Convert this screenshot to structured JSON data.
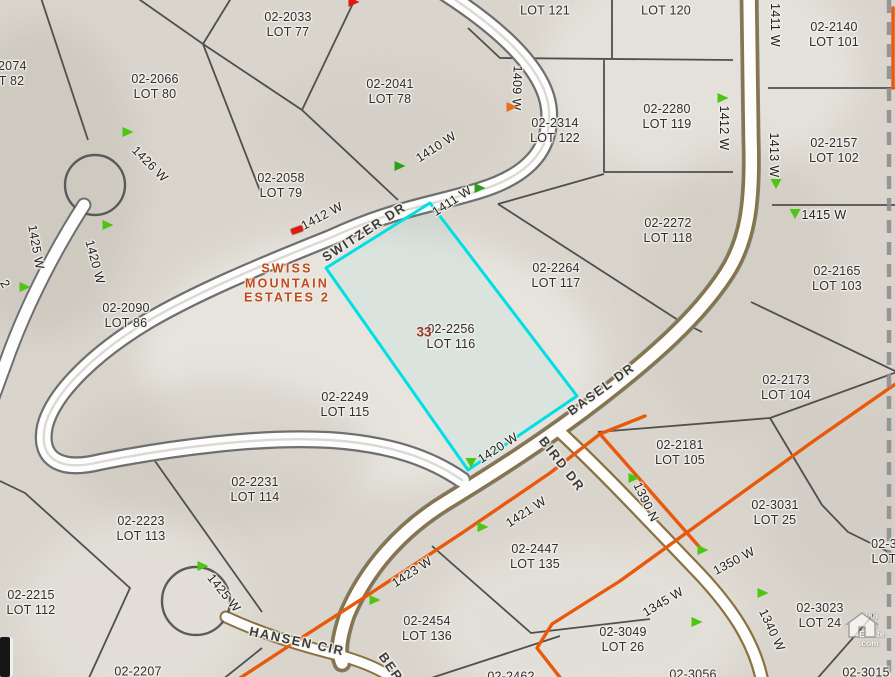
{
  "map": {
    "subdivision": {
      "lines": [
        "SWISS",
        "MOUNTAIN",
        "ESTATES 2"
      ],
      "color": "#c14a1d"
    },
    "site_number": {
      "text": "33",
      "color": "#9c3726"
    },
    "colors": {
      "selected_parcel_outline": "#00dfe4",
      "subdivision_boundary": "#e8590c",
      "road_fill": "#fdfdfd",
      "road_casing_gray": "#6f6f6f",
      "road_casing_brown": "#8a7340",
      "parcel_line": "#4f4f4f",
      "terrain_base": "#d9d5cc"
    },
    "watermark": {
      "lines": [
        "Utah",
        "Real",
        "Estate",
        ".com"
      ]
    }
  },
  "parcels": [
    {
      "id": "02-2033",
      "lot": "LOT 77",
      "x": 288,
      "y": 25
    },
    {
      "id": "02-2074",
      "lot": "LOT 82",
      "x": 3,
      "y": 74
    },
    {
      "id": "02-2066",
      "lot": "LOT 80",
      "x": 155,
      "y": 87
    },
    {
      "id": "02-2041",
      "lot": "LOT 78",
      "x": 390,
      "y": 92
    },
    {
      "id": "02-2058",
      "lot": "LOT 79",
      "x": 281,
      "y": 186
    },
    {
      "id": "",
      "lot": "LOT 121",
      "x": 545,
      "y": 11
    },
    {
      "id": "",
      "lot": "LOT 120",
      "x": 666,
      "y": 11
    },
    {
      "id": "02-2140",
      "lot": "LOT 101",
      "x": 834,
      "y": 35
    },
    {
      "id": "02-2280",
      "lot": "LOT 119",
      "x": 667,
      "y": 117
    },
    {
      "id": "02-2314",
      "lot": "LOT 122",
      "x": 555,
      "y": 131
    },
    {
      "id": "02-2157",
      "lot": "LOT 102",
      "x": 834,
      "y": 151
    },
    {
      "id": "02-2272",
      "lot": "LOT 118",
      "x": 668,
      "y": 231
    },
    {
      "id": "02-2264",
      "lot": "LOT 117",
      "x": 556,
      "y": 276
    },
    {
      "id": "02-2165",
      "lot": "LOT 103",
      "x": 837,
      "y": 279
    },
    {
      "id": "02-2256",
      "lot": "LOT 116",
      "x": 451,
      "y": 337
    },
    {
      "id": "02-2090",
      "lot": "LOT 86",
      "x": 126,
      "y": 316
    },
    {
      "id": "02-2173",
      "lot": "LOT 104",
      "x": 786,
      "y": 388
    },
    {
      "id": "02-2249",
      "lot": "LOT 115",
      "x": 345,
      "y": 405
    },
    {
      "id": "02-2181",
      "lot": "LOT 105",
      "x": 680,
      "y": 453
    },
    {
      "id": "02-2231",
      "lot": "LOT 114",
      "x": 255,
      "y": 490
    },
    {
      "id": "02-3031",
      "lot": "LOT 25",
      "x": 775,
      "y": 513
    },
    {
      "id": "02-2223",
      "lot": "LOT 113",
      "x": 141,
      "y": 529
    },
    {
      "id": "02-2447",
      "lot": "LOT 135",
      "x": 535,
      "y": 557
    },
    {
      "id": "02-2215",
      "lot": "LOT 112",
      "x": 31,
      "y": 603
    },
    {
      "id": "02-3049",
      "lot": "LOT 26",
      "x": 623,
      "y": 640
    },
    {
      "id": "02-3023",
      "lot": "LOT 24",
      "x": 820,
      "y": 616
    },
    {
      "id": "02-2454",
      "lot": "LOT 136",
      "x": 427,
      "y": 629
    },
    {
      "id": "02-3",
      "lot": "LOT",
      "x": 884,
      "y": 552
    },
    {
      "id": "02-2207",
      "lot": "",
      "x": 138,
      "y": 672
    },
    {
      "id": "02-2462",
      "lot": "",
      "x": 511,
      "y": 677
    },
    {
      "id": "02-3056",
      "lot": "",
      "x": 693,
      "y": 675
    },
    {
      "id": "02-3015",
      "lot": "",
      "x": 866,
      "y": 673
    }
  ],
  "addresses": [
    {
      "text": "1426 W",
      "x": 150,
      "y": 164,
      "angle": 45
    },
    {
      "text": "1425 W",
      "x": 36,
      "y": 247,
      "angle": 80
    },
    {
      "text": "1420 W",
      "x": 95,
      "y": 262,
      "angle": 75
    },
    {
      "text": "2",
      "x": 5,
      "y": 284,
      "angle": 60
    },
    {
      "text": "1410 W",
      "x": 436,
      "y": 147,
      "angle": -33
    },
    {
      "text": "1412 W",
      "x": 322,
      "y": 216,
      "angle": -28
    },
    {
      "text": "1411 W",
      "x": 452,
      "y": 201,
      "angle": -33
    },
    {
      "text": "1409 W",
      "x": 517,
      "y": 88,
      "angle": 92
    },
    {
      "text": "1411 W",
      "x": 775,
      "y": 25,
      "angle": 90
    },
    {
      "text": "1412 W",
      "x": 724,
      "y": 128,
      "angle": 90
    },
    {
      "text": "1413 W",
      "x": 774,
      "y": 155,
      "angle": 90
    },
    {
      "text": "1415 W",
      "x": 824,
      "y": 215,
      "angle": 0
    },
    {
      "text": "1420 W",
      "x": 498,
      "y": 448,
      "angle": -33
    },
    {
      "text": "1421 W",
      "x": 526,
      "y": 512,
      "angle": -33
    },
    {
      "text": "1423 W",
      "x": 412,
      "y": 572,
      "angle": -33
    },
    {
      "text": "1425 W",
      "x": 224,
      "y": 593,
      "angle": 51
    },
    {
      "text": "1350 W",
      "x": 734,
      "y": 561,
      "angle": -28
    },
    {
      "text": "1345 W",
      "x": 663,
      "y": 602,
      "angle": -31
    },
    {
      "text": "1340 W",
      "x": 772,
      "y": 630,
      "angle": 65
    },
    {
      "text": "1390 N",
      "x": 646,
      "y": 502,
      "angle": 64
    }
  ],
  "roads": [
    {
      "name": "SWITZER DR",
      "x": 364,
      "y": 232,
      "angle": -33
    },
    {
      "name": "BASEL DR",
      "x": 601,
      "y": 389,
      "angle": -36
    },
    {
      "name": "BIRD DR",
      "x": 562,
      "y": 464,
      "angle": 52
    },
    {
      "name": "HANSEN CIR",
      "x": 297,
      "y": 641,
      "angle": 12
    },
    {
      "name": "BER",
      "x": 391,
      "y": 667,
      "angle": 55
    }
  ],
  "markers": [
    {
      "shape": "tri-right",
      "color": "#4ec414",
      "x": 128,
      "y": 132
    },
    {
      "shape": "tri-right",
      "color": "#4ec414",
      "x": 25,
      "y": 287
    },
    {
      "shape": "tri-right",
      "color": "#4ec414",
      "x": 108,
      "y": 225
    },
    {
      "shape": "tri-right",
      "color": "#2f9e1b",
      "x": 400,
      "y": 166
    },
    {
      "shape": "tri-right",
      "color": "#2f9e1b",
      "x": 480,
      "y": 188
    },
    {
      "shape": "tri-right",
      "color": "#4ec414",
      "x": 723,
      "y": 98
    },
    {
      "shape": "tri-down",
      "color": "#4ec414",
      "x": 776,
      "y": 184
    },
    {
      "shape": "tri-down",
      "color": "#4ec414",
      "x": 795,
      "y": 214
    },
    {
      "shape": "tri-down",
      "color": "#4ec414",
      "x": 471,
      "y": 463
    },
    {
      "shape": "tri-right",
      "color": "#4ec414",
      "x": 483,
      "y": 527
    },
    {
      "shape": "tri-right",
      "color": "#4ec414",
      "x": 375,
      "y": 600
    },
    {
      "shape": "tri-right",
      "color": "#4ec414",
      "x": 634,
      "y": 478
    },
    {
      "shape": "tri-right",
      "color": "#4ec414",
      "x": 703,
      "y": 550
    },
    {
      "shape": "tri-right",
      "color": "#4ec414",
      "x": 763,
      "y": 593
    },
    {
      "shape": "tri-right",
      "color": "#4ec414",
      "x": 697,
      "y": 622
    },
    {
      "shape": "tri-right",
      "color": "#4ec414",
      "x": 203,
      "y": 566
    },
    {
      "shape": "tri-right",
      "color": "#e8711f",
      "x": 512,
      "y": 107
    },
    {
      "shape": "rect",
      "color": "#e31515",
      "x": 297,
      "y": 230
    },
    {
      "shape": "tri-right",
      "color": "#e31515",
      "x": 354,
      "y": 2
    }
  ]
}
